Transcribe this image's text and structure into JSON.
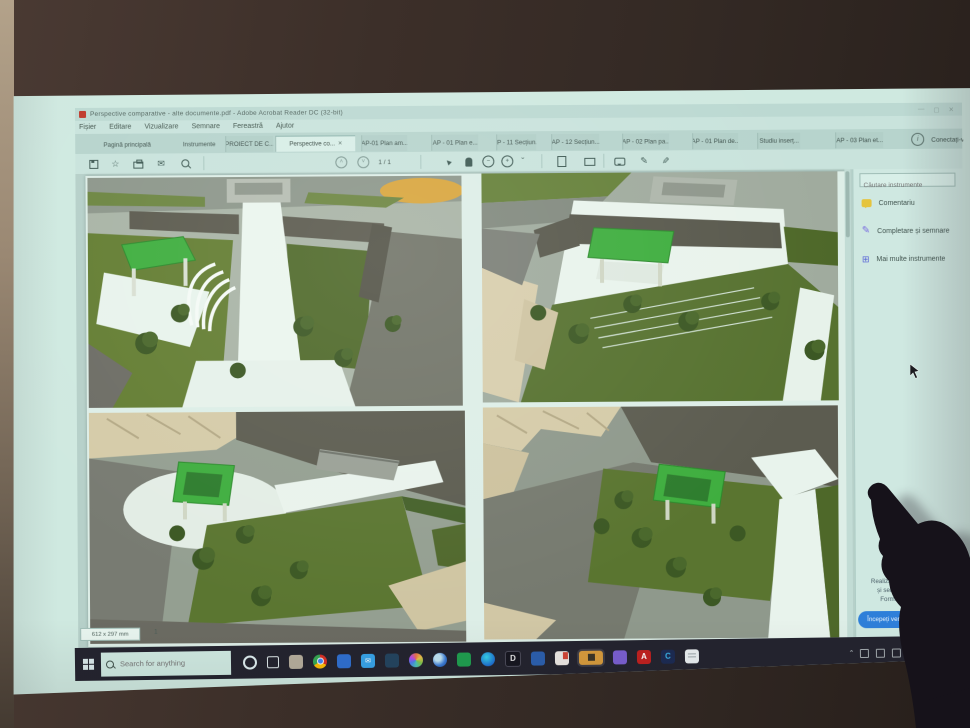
{
  "titlebar": {
    "title": "Perspective comparative - alte documente.pdf - Adobe Acrobat Reader DC (32-bit)",
    "controls": {
      "minimize": "—",
      "maximize": "▢",
      "close": "✕"
    }
  },
  "menu": {
    "items": [
      "Fișier",
      "Editare",
      "Vizualizare",
      "Semnare",
      "Fereastră",
      "Ajutor"
    ]
  },
  "tabs": {
    "home": "Pagină principală",
    "tools": "Instrumente",
    "close_glyph": "×",
    "documents": [
      {
        "label": "PROIECT DE C..."
      },
      {
        "label": "Perspective co..."
      },
      {
        "label": "AP-01 Plan am..."
      },
      {
        "label": "AP - 01 Plan e..."
      },
      {
        "label": "AP - 11 Secțiun..."
      },
      {
        "label": "AP - 12 Secțiun..."
      },
      {
        "label": "AP - 02 Plan pa..."
      },
      {
        "label": "AP - 01 Plan de..."
      },
      {
        "label": "Studiu inserț..."
      },
      {
        "label": "AP - 03 Plan et..."
      }
    ],
    "info_glyph": "i",
    "sign_in": "Conectați-vă"
  },
  "toolbar": {
    "page_indicator": "1 / 1",
    "star_glyph": "☆",
    "mail_glyph": "✉",
    "cursor_glyph": "►",
    "minus_glyph": "−",
    "plus_glyph": "+",
    "caret_glyph": "ˇ",
    "pen_glyph": "✎",
    "nib_glyph": "✎"
  },
  "document": {
    "page_size": "612 x 297 mm",
    "page_number": "1"
  },
  "panel": {
    "search_placeholder": "Căutare instrumente",
    "tools": [
      {
        "label": "Comentariu"
      },
      {
        "label": "Completare și semnare"
      },
      {
        "label": "Mai multe instrumente"
      }
    ],
    "more_tools_glyph": "⊞",
    "promo_lines": [
      "Realizați conversia fișierelor",
      "și semnați-le electronic.",
      "Formulare și acorduri"
    ],
    "trial_button": "Începeți versiunea de încercare"
  },
  "taskbar": {
    "search_placeholder": "Search for anything",
    "apps": [
      {
        "name": "cortana",
        "glyph": ""
      },
      {
        "name": "task-view",
        "glyph": ""
      },
      {
        "name": "vault-app",
        "glyph": ""
      },
      {
        "name": "chrome",
        "glyph": ""
      },
      {
        "name": "maps-app",
        "glyph": ""
      },
      {
        "name": "mail",
        "glyph": "✉"
      },
      {
        "name": "movies-app",
        "glyph": ""
      },
      {
        "name": "photos-app",
        "glyph": ""
      },
      {
        "name": "earth-app",
        "glyph": ""
      },
      {
        "name": "green-app",
        "glyph": ""
      },
      {
        "name": "edge",
        "glyph": ""
      },
      {
        "name": "d-app",
        "glyph": "D"
      },
      {
        "name": "word",
        "glyph": ""
      },
      {
        "name": "red-doc-app",
        "glyph": ""
      },
      {
        "name": "active-app",
        "glyph": ""
      },
      {
        "name": "purple-app",
        "glyph": ""
      },
      {
        "name": "acrobat",
        "glyph": "A"
      },
      {
        "name": "creative-cloud",
        "glyph": "C"
      },
      {
        "name": "notepad",
        "glyph": ""
      }
    ],
    "tray": {
      "chevron": "ˆ",
      "language": "ENG",
      "region": "US"
    }
  }
}
